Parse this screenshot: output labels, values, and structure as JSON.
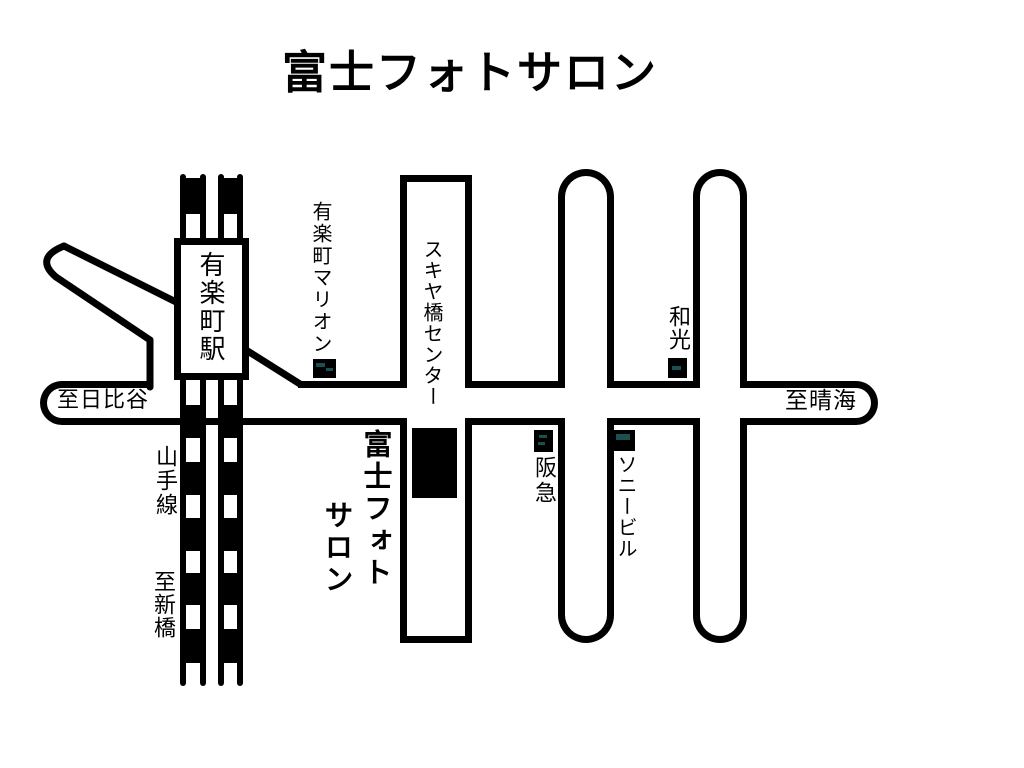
{
  "page": {
    "title": "富士フォトサロン"
  },
  "map": {
    "station": {
      "name": "有楽町駅"
    },
    "railway": {
      "line_name": "山手線",
      "direction_south": "至新橋"
    },
    "road_directions": {
      "west": "至日比谷",
      "east": "至晴海"
    },
    "landmarks": {
      "marion": {
        "name": "有楽町マリオン"
      },
      "sukiyabashi_center": {
        "name": "スキヤ橋センター"
      },
      "fuji_photo_salon": {
        "name_line1": "富士フォト",
        "name_line2": "サロン"
      },
      "hankyu": {
        "name": "阪急"
      },
      "sony_building": {
        "name": "ソニービル"
      },
      "wako": {
        "name": "和光"
      }
    },
    "colors": {
      "ink": "#000000",
      "road_fill": "#ffffff",
      "marker_fill": "#000000",
      "marker_accent": "#1c4f4f"
    }
  }
}
